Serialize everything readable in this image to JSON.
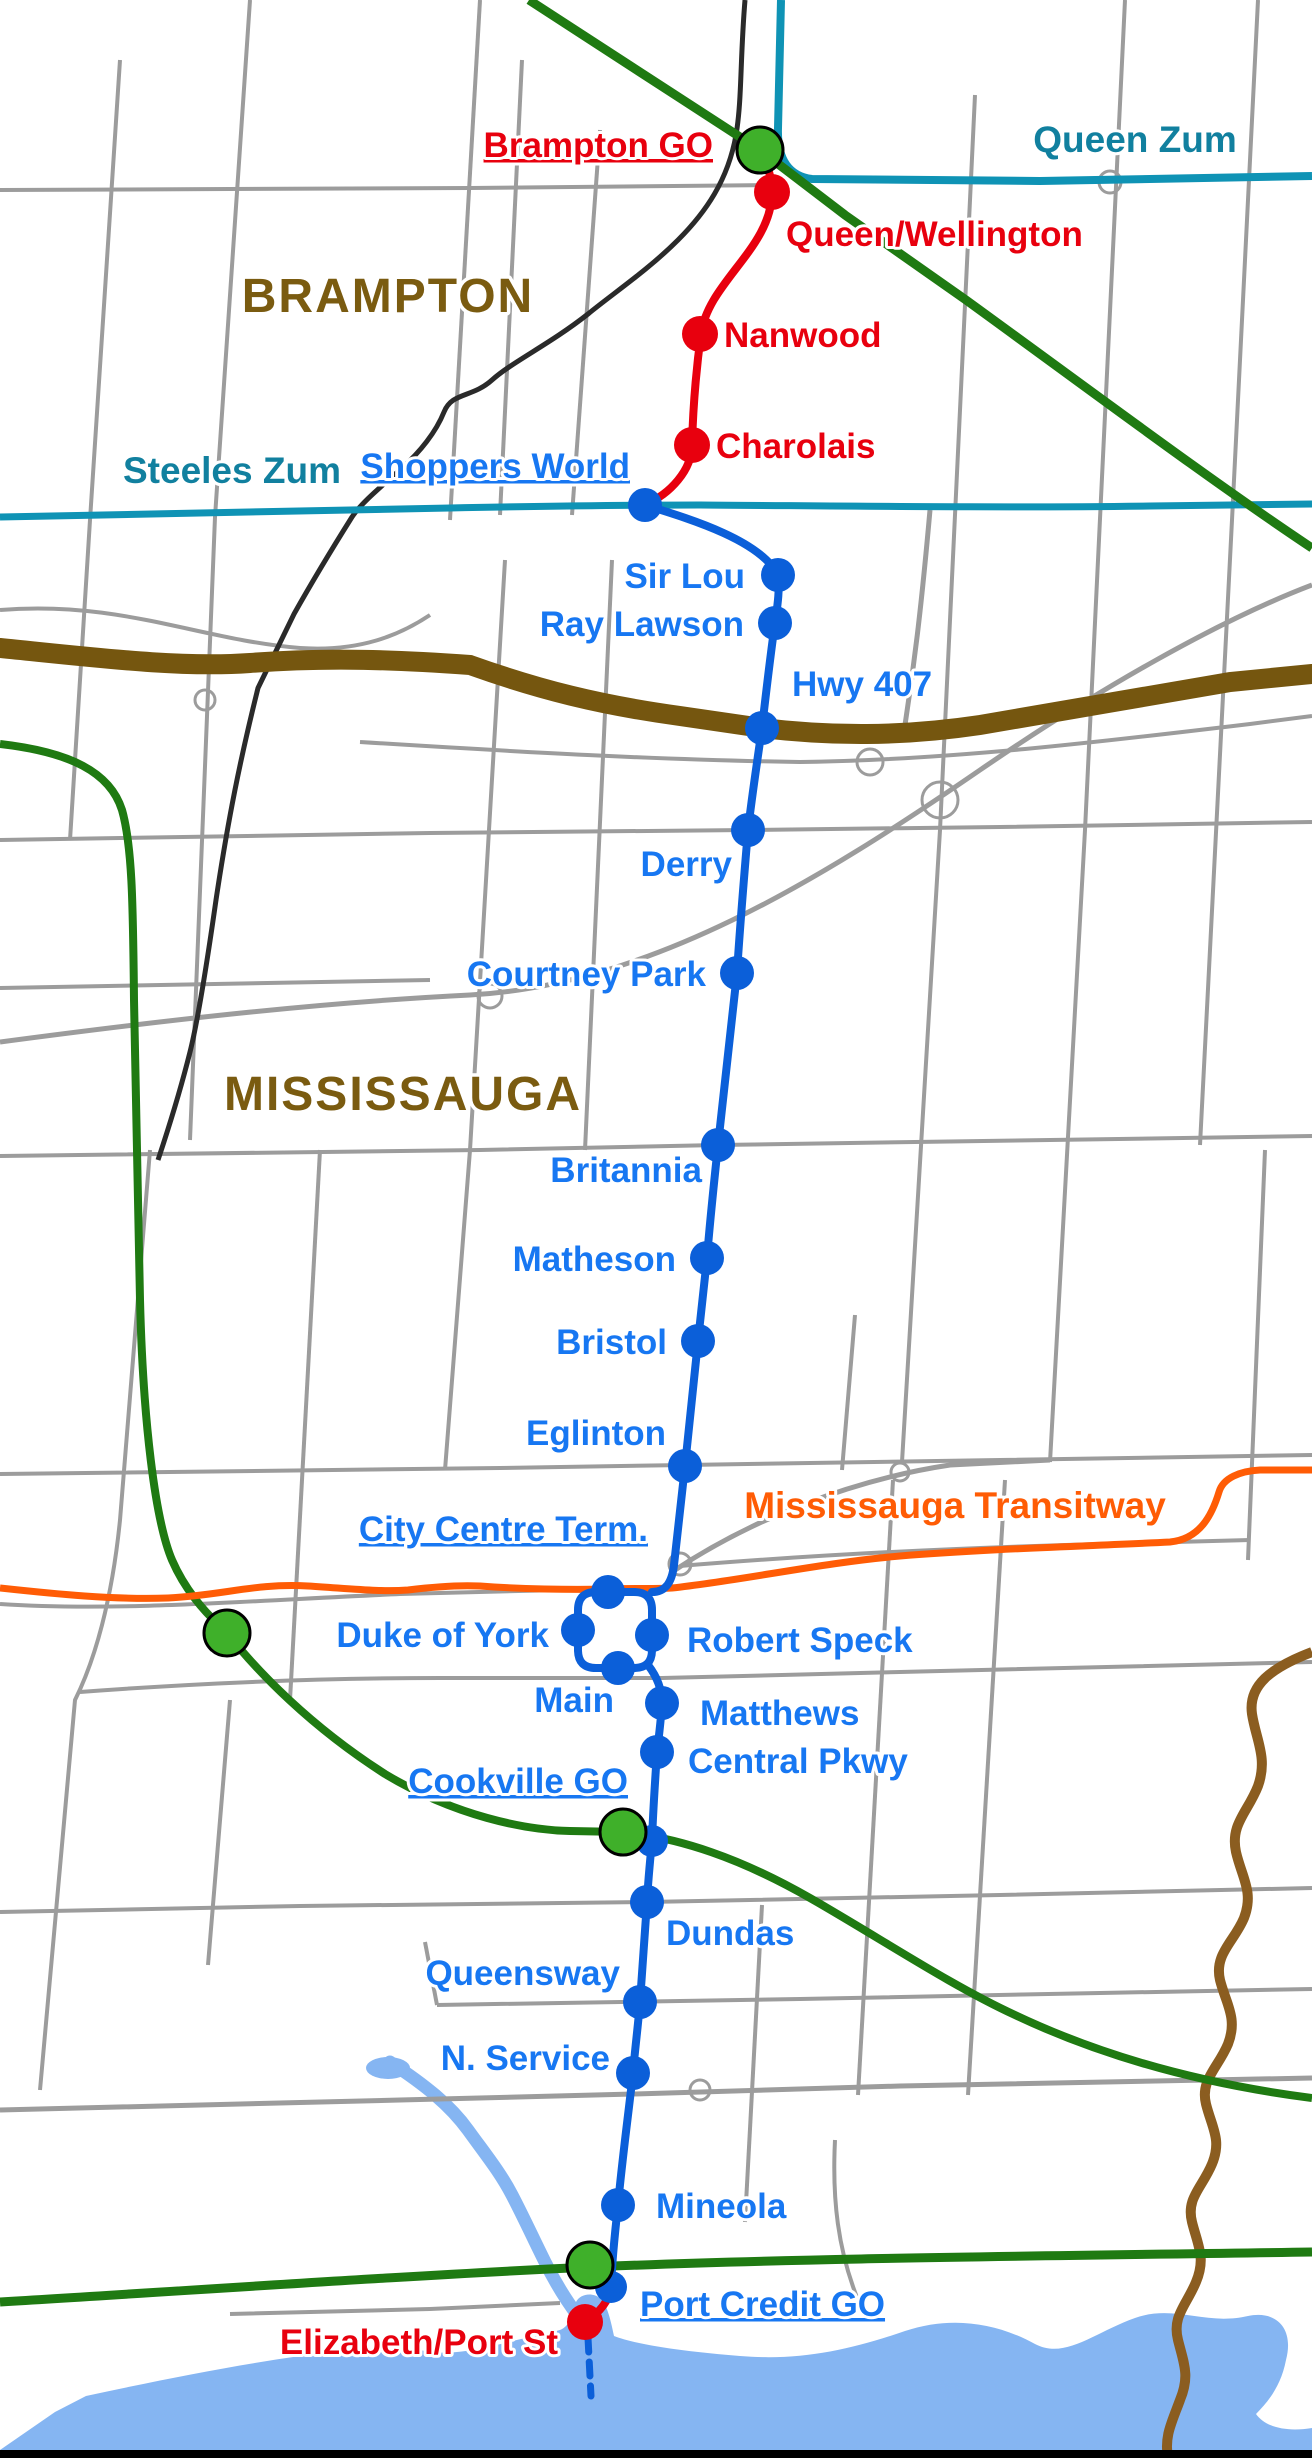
{
  "colors": {
    "background": "#ffffff",
    "line_red": "#e8000e",
    "label_red": "#e8000e",
    "line_blue": "#0b5fd9",
    "label_blue": "#1777f2",
    "go_green": "#3fb02a",
    "go_line_green": "#1f7a12",
    "teal": "#0f93b5",
    "label_teal": "#11809f",
    "orange": "#ff5c05",
    "hwy407_brown": "#75560f",
    "city_label_brown": "#7a5b10",
    "creek_brown": "#8b5d20",
    "road_gray": "#9c9c9c",
    "boundary_black": "#2a2a2a",
    "water_blue": "#85b5f2",
    "border_black": "#000000"
  },
  "region_labels": [
    {
      "text": "BRAMPTON"
    },
    {
      "text": "MISSISSAUGA"
    }
  ],
  "route_labels": [
    {
      "text": "Queen Zum"
    },
    {
      "text": "Steeles Zum"
    },
    {
      "text": "Mississauga Transitway"
    },
    {
      "text": "Hwy 407"
    }
  ],
  "stations": [
    {
      "label": "Brampton GO",
      "x": 760,
      "y": 150,
      "dot": "go",
      "label_x": 713,
      "label_y": 157,
      "anchor": "end",
      "label_color": "red",
      "underline": true
    },
    {
      "label": "Queen/Wellington",
      "x": 772,
      "y": 192,
      "dot": "red",
      "label_x": 786,
      "label_y": 246,
      "anchor": "start",
      "label_color": "red",
      "underline": false
    },
    {
      "label": "Nanwood",
      "x": 700,
      "y": 334,
      "dot": "red",
      "label_x": 724,
      "label_y": 347,
      "anchor": "start",
      "label_color": "red",
      "underline": false
    },
    {
      "label": "Charolais",
      "x": 692,
      "y": 445,
      "dot": "red",
      "label_x": 716,
      "label_y": 458,
      "anchor": "start",
      "label_color": "red",
      "underline": false
    },
    {
      "label": "Shoppers World",
      "x": 645,
      "y": 505,
      "dot": "blue",
      "label_x": 630,
      "label_y": 478,
      "anchor": "end",
      "label_color": "blue",
      "underline": true
    },
    {
      "label": "Sir Lou",
      "x": 778,
      "y": 575,
      "dot": "blue",
      "label_x": 745,
      "label_y": 588,
      "anchor": "end",
      "label_color": "blue",
      "underline": false
    },
    {
      "label": "Ray Lawson",
      "x": 775,
      "y": 623,
      "dot": "blue",
      "label_x": 744,
      "label_y": 636,
      "anchor": "end",
      "label_color": "blue",
      "underline": false
    },
    {
      "label": "Hwy 407",
      "x": 762,
      "y": 728,
      "dot": "blue",
      "label_x": 792,
      "label_y": 696,
      "anchor": "start",
      "label_color": "blue",
      "underline": false
    },
    {
      "label": "Derry",
      "x": 748,
      "y": 830,
      "dot": "blue",
      "label_x": 732,
      "label_y": 876,
      "anchor": "end",
      "label_color": "blue",
      "underline": false
    },
    {
      "label": "Courtney Park",
      "x": 737,
      "y": 973,
      "dot": "blue",
      "label_x": 706,
      "label_y": 986,
      "anchor": "end",
      "label_color": "blue",
      "underline": false
    },
    {
      "label": "Britannia",
      "x": 718,
      "y": 1145,
      "dot": "blue",
      "label_x": 702,
      "label_y": 1182,
      "anchor": "end",
      "label_color": "blue",
      "underline": false
    },
    {
      "label": "Matheson",
      "x": 707,
      "y": 1258,
      "dot": "blue",
      "label_x": 676,
      "label_y": 1271,
      "anchor": "end",
      "label_color": "blue",
      "underline": false
    },
    {
      "label": "Bristol",
      "x": 698,
      "y": 1341,
      "dot": "blue",
      "label_x": 667,
      "label_y": 1354,
      "anchor": "end",
      "label_color": "blue",
      "underline": false
    },
    {
      "label": "Eglinton",
      "x": 685,
      "y": 1466,
      "dot": "blue",
      "label_x": 666,
      "label_y": 1445,
      "anchor": "end",
      "label_color": "blue",
      "underline": false
    },
    {
      "label": "City Centre Term.",
      "x": 608,
      "y": 1592,
      "dot": "blue",
      "label_x": 648,
      "label_y": 1541,
      "anchor": "end",
      "label_color": "blue",
      "underline": true
    },
    {
      "label": "Duke of York",
      "x": 578,
      "y": 1630,
      "dot": "blue",
      "label_x": 549,
      "label_y": 1647,
      "anchor": "end",
      "label_color": "blue",
      "underline": false
    },
    {
      "label": "Robert Speck",
      "x": 652,
      "y": 1635,
      "dot": "blue",
      "label_x": 687,
      "label_y": 1652,
      "anchor": "start",
      "label_color": "blue",
      "underline": false
    },
    {
      "label": "Main",
      "x": 618,
      "y": 1668,
      "dot": "blue",
      "label_x": 614,
      "label_y": 1712,
      "anchor": "end",
      "label_color": "blue",
      "underline": false
    },
    {
      "label": "Matthews",
      "x": 662,
      "y": 1703,
      "dot": "blue",
      "label_x": 700,
      "label_y": 1725,
      "anchor": "start",
      "label_color": "blue",
      "underline": false
    },
    {
      "label": "Central Pkwy",
      "x": 657,
      "y": 1752,
      "dot": "blue",
      "label_x": 688,
      "label_y": 1773,
      "anchor": "start",
      "label_color": "blue",
      "underline": false
    },
    {
      "label": "Cookville GO",
      "x": 623,
      "y": 1832,
      "dot": "go",
      "label_x": 628,
      "label_y": 1793,
      "anchor": "end",
      "label_color": "blue",
      "underline": true
    },
    {
      "label": "Dundas",
      "x": 647,
      "y": 1902,
      "dot": "blue",
      "label_x": 666,
      "label_y": 1945,
      "anchor": "start",
      "label_color": "blue",
      "underline": false
    },
    {
      "label": "Queensway",
      "x": 640,
      "y": 2002,
      "dot": "blue",
      "label_x": 620,
      "label_y": 1985,
      "anchor": "end",
      "label_color": "blue",
      "underline": false
    },
    {
      "label": "N. Service",
      "x": 633,
      "y": 2073,
      "dot": "blue",
      "label_x": 610,
      "label_y": 2070,
      "anchor": "end",
      "label_color": "blue",
      "underline": false
    },
    {
      "label": "Mineola",
      "x": 618,
      "y": 2205,
      "dot": "blue",
      "label_x": 656,
      "label_y": 2218,
      "anchor": "start",
      "label_color": "blue",
      "underline": false
    },
    {
      "label": "Port Credit GO",
      "x": 590,
      "y": 2265,
      "dot": "go",
      "label_x": 640,
      "label_y": 2316,
      "anchor": "start",
      "label_color": "blue",
      "underline": true
    },
    {
      "label": "Elizabeth/Port St",
      "x": 585,
      "y": 2322,
      "dot": "red",
      "label_x": 558,
      "label_y": 2354,
      "anchor": "end",
      "label_color": "red",
      "underline": false
    }
  ],
  "extra_dots": [
    {
      "x": 652,
      "y": 1841,
      "type": "line-blue"
    },
    {
      "x": 611,
      "y": 2287,
      "type": "line-blue"
    },
    {
      "x": 227,
      "y": 1633,
      "type": "go"
    }
  ]
}
